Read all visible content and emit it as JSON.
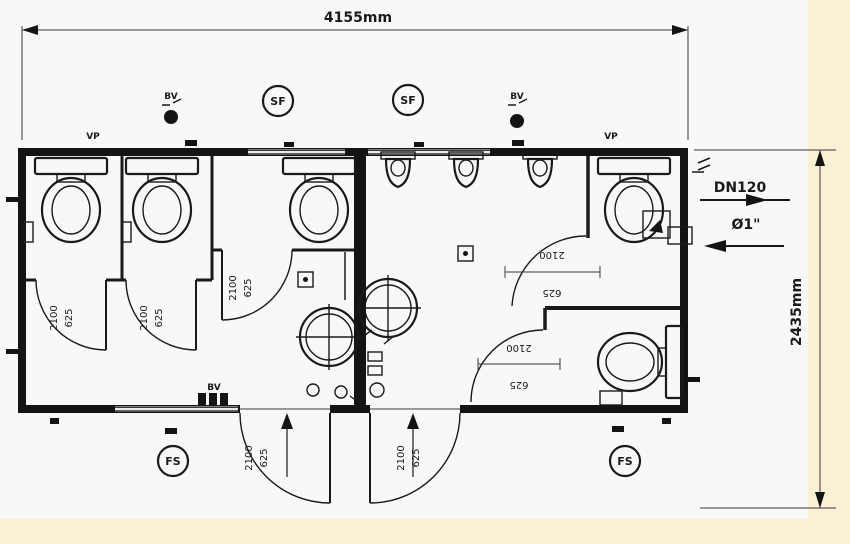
{
  "colors": {
    "background": "#faf0d6",
    "paper": "#f8f8f6",
    "ink": "#1a1a1a"
  },
  "dims": {
    "width": "4155mm",
    "depth": "2435mm"
  },
  "pipe_labels": {
    "dn": "DN120",
    "diameter": "Ø1\""
  },
  "symbols": {
    "supply_fan": "SF",
    "vent_valve": "BV",
    "vent_pipe": "VP",
    "floor_drain": "FS"
  },
  "door": {
    "width": "625",
    "height": "2100"
  }
}
